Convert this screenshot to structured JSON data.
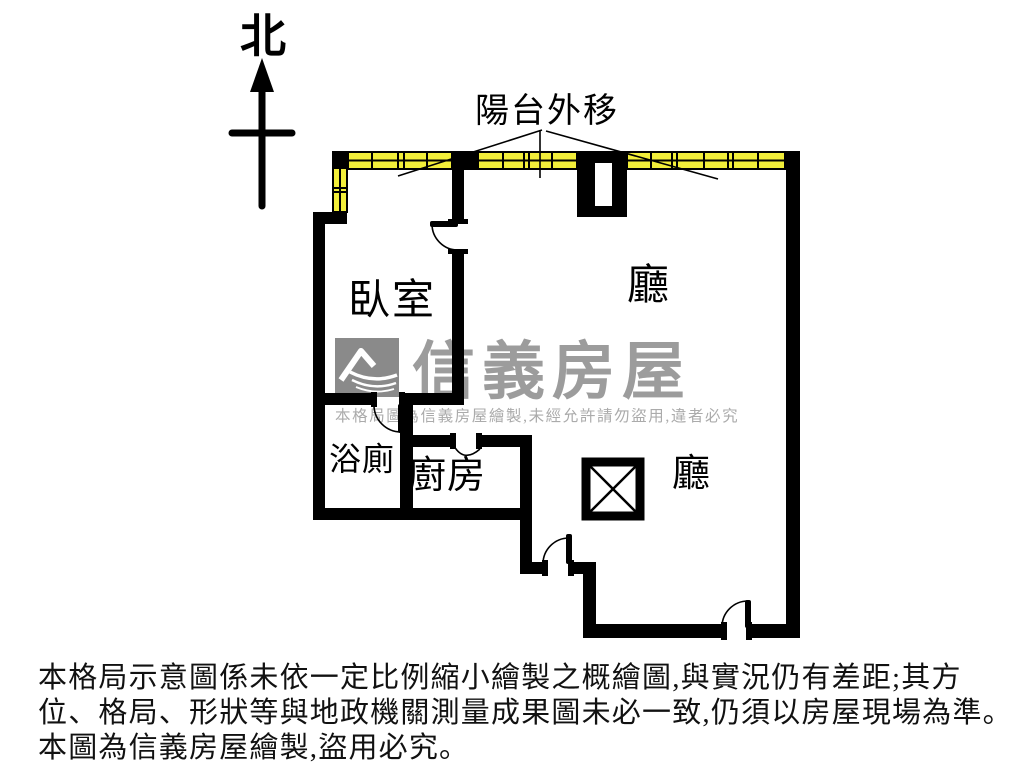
{
  "title": "apartment-floor-plan",
  "compass": {
    "north_label": "北"
  },
  "plan": {
    "balcony_label": "陽台外移",
    "rooms": {
      "bedroom": "臥室",
      "living_upper": "廳",
      "bathroom": "浴廁",
      "kitchen": "廚房",
      "living_lower": "廳"
    },
    "colors": {
      "wall": "#000000",
      "window_fill": "#f2ee3a",
      "background": "#ffffff"
    },
    "icons": {
      "north_arrow": "north-arrow-icon",
      "pillar": "crossed-square-pillar-icon",
      "doors": "door-swing-arc-icon",
      "windows": "balcony-window-strip"
    }
  },
  "watermark": {
    "brand": "信義房屋",
    "logo_name": "sinyi-mountain-logo-icon",
    "notice": "本格局圖為信義房屋繪製,未經允許請勿盜用,違者必究",
    "brand_color": "#9c9c9c",
    "logo_color": "#8a8a8a",
    "notice_color": "#ababab"
  },
  "disclaimer": {
    "color": "#111111",
    "lines": [
      "本格局示意圖係未依一定比例縮小繪製之概繪圖,與實況仍有差距;其方",
      "位、格局、形狀等與地政機關測量成果圖未必一致,仍須以房屋現場為準。",
      "本圖為信義房屋繪製,盜用必究。"
    ]
  }
}
